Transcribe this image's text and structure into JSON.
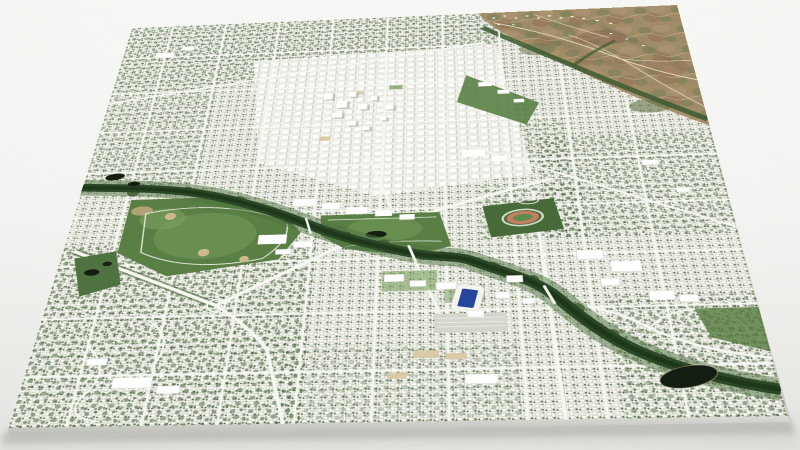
{
  "scene": {
    "type": "3d-aerial-city-map-model",
    "description": "Perspective render of a satellite city map slab on a neutral studio background",
    "landmarks": [
      "downtown-towers",
      "blue-turf-stadium",
      "track-and-field-stadium",
      "river-greenbelt",
      "foothills-terrain",
      "city-parks",
      "parkcenter-pond"
    ],
    "colors": {
      "backdrop_top": "#f8f8f6",
      "backdrop_bottom": "#e7e7e4",
      "urban_base": "#d7d8cd",
      "street": "#f2f2ec",
      "building": "#ffffff",
      "tree_canopy": "#46633a",
      "park": "#5a7f45",
      "river": "#2b4826",
      "greenbelt": "#4d7140",
      "foothills": "#a18c68",
      "foothills_scrub": "#7c815a",
      "foothills_rust": "#8d6952",
      "stadium_blue_turf": "#27459c",
      "track_ring": "#c47f60",
      "track_infield": "#5d8a4f",
      "pond": "#141d12",
      "slab_side": "#c4c4c0",
      "slab_shadow": "#9a9a96"
    }
  }
}
